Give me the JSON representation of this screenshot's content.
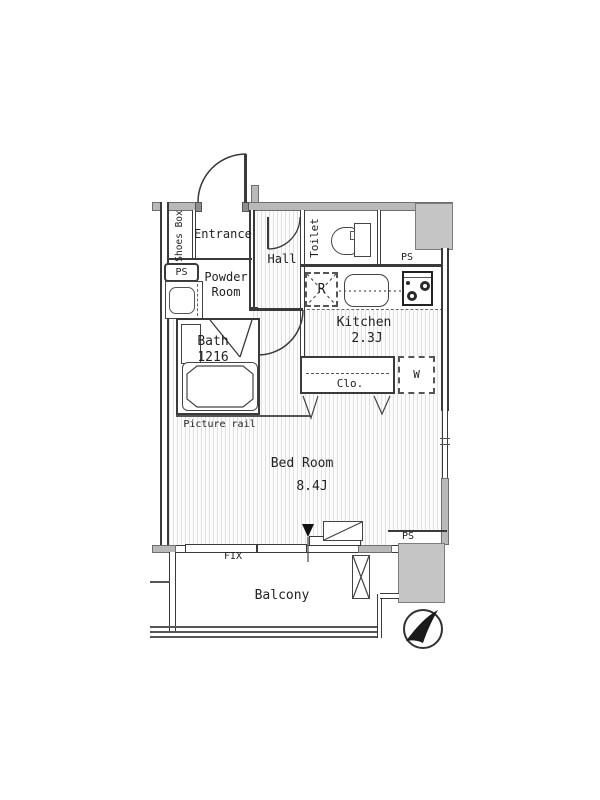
{
  "plan": {
    "title": "apartment floor plan",
    "rooms": {
      "entrance": {
        "label": "Entrance"
      },
      "shoes_box": {
        "label": "Shoes Box"
      },
      "hall": {
        "label": "Hall"
      },
      "toilet": {
        "label": "Toilet"
      },
      "powder_room": {
        "line1": "Powder",
        "line2": "Room"
      },
      "bath": {
        "line1": "Bath",
        "line2": "1216"
      },
      "kitchen": {
        "name": "Kitchen",
        "size": "2.3J"
      },
      "bed_room": {
        "name": "Bed Room",
        "size": "8.4J"
      },
      "closet": {
        "label": "Clo."
      },
      "washer": {
        "label": "W"
      },
      "refrigerator": {
        "label": "R"
      },
      "balcony": {
        "label": "Balcony"
      }
    },
    "annotations": {
      "ps_left": "PS",
      "ps_top_right": "PS",
      "ps_bottom_right": "PS",
      "picture_rail": "Picture rail",
      "fix_window": "FIX"
    },
    "colors": {
      "wall_fill": "#b9b9b9",
      "shaft_fill": "#c5c5c5",
      "line": "#3a3a3a",
      "text": "#222222"
    }
  }
}
